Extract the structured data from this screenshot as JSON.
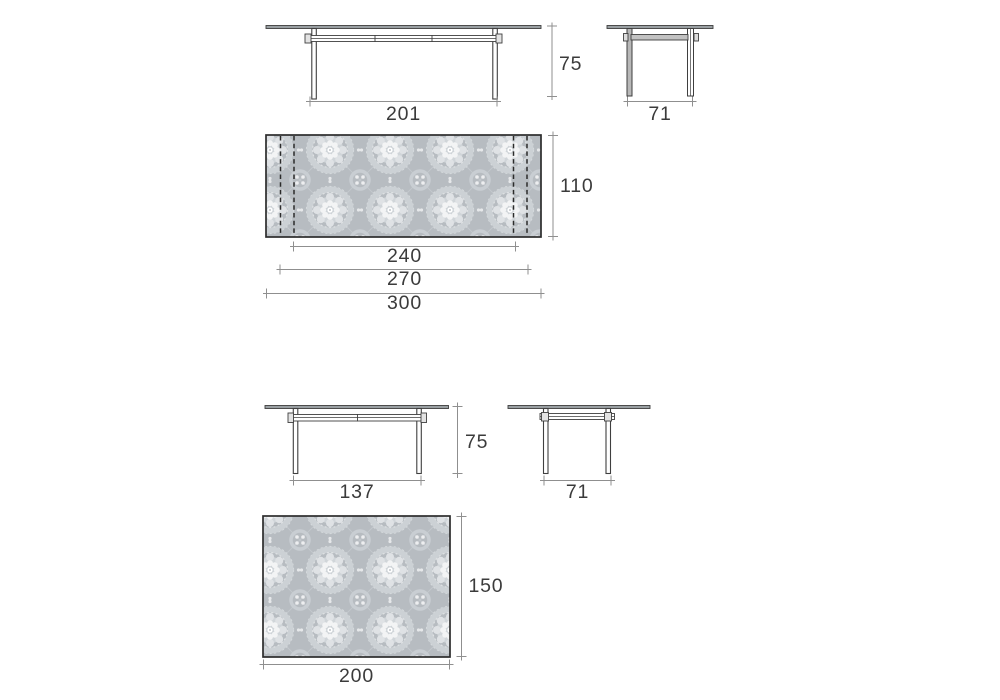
{
  "document": {
    "type": "furniture-dimension-drawing",
    "background": "#ffffff"
  },
  "colors": {
    "drawing_line": "#3f3f3f",
    "top_view_border": "#2c2c2c",
    "dimension_line": "#8f8f8f",
    "dimension_text": "#3b3b3b",
    "tabletop_fill": "#9aa0a3",
    "pattern_background": "#b7bcc1",
    "pattern_lace": "#e9ebec",
    "dashed_leaf_line": "#2b2b2b"
  },
  "views": {
    "extendable_table": {
      "front": {
        "width_label": "201",
        "height_label": "75"
      },
      "side": {
        "width_label": "71"
      },
      "top": {
        "depth_label": "110",
        "width_min_label": "240",
        "width_mid_label": "270",
        "width_max_label": "300"
      }
    },
    "fixed_table": {
      "front": {
        "width_label": "137",
        "height_label": "75"
      },
      "side": {
        "width_label": "71"
      },
      "top": {
        "depth_label": "150",
        "width_label": "200"
      }
    }
  }
}
